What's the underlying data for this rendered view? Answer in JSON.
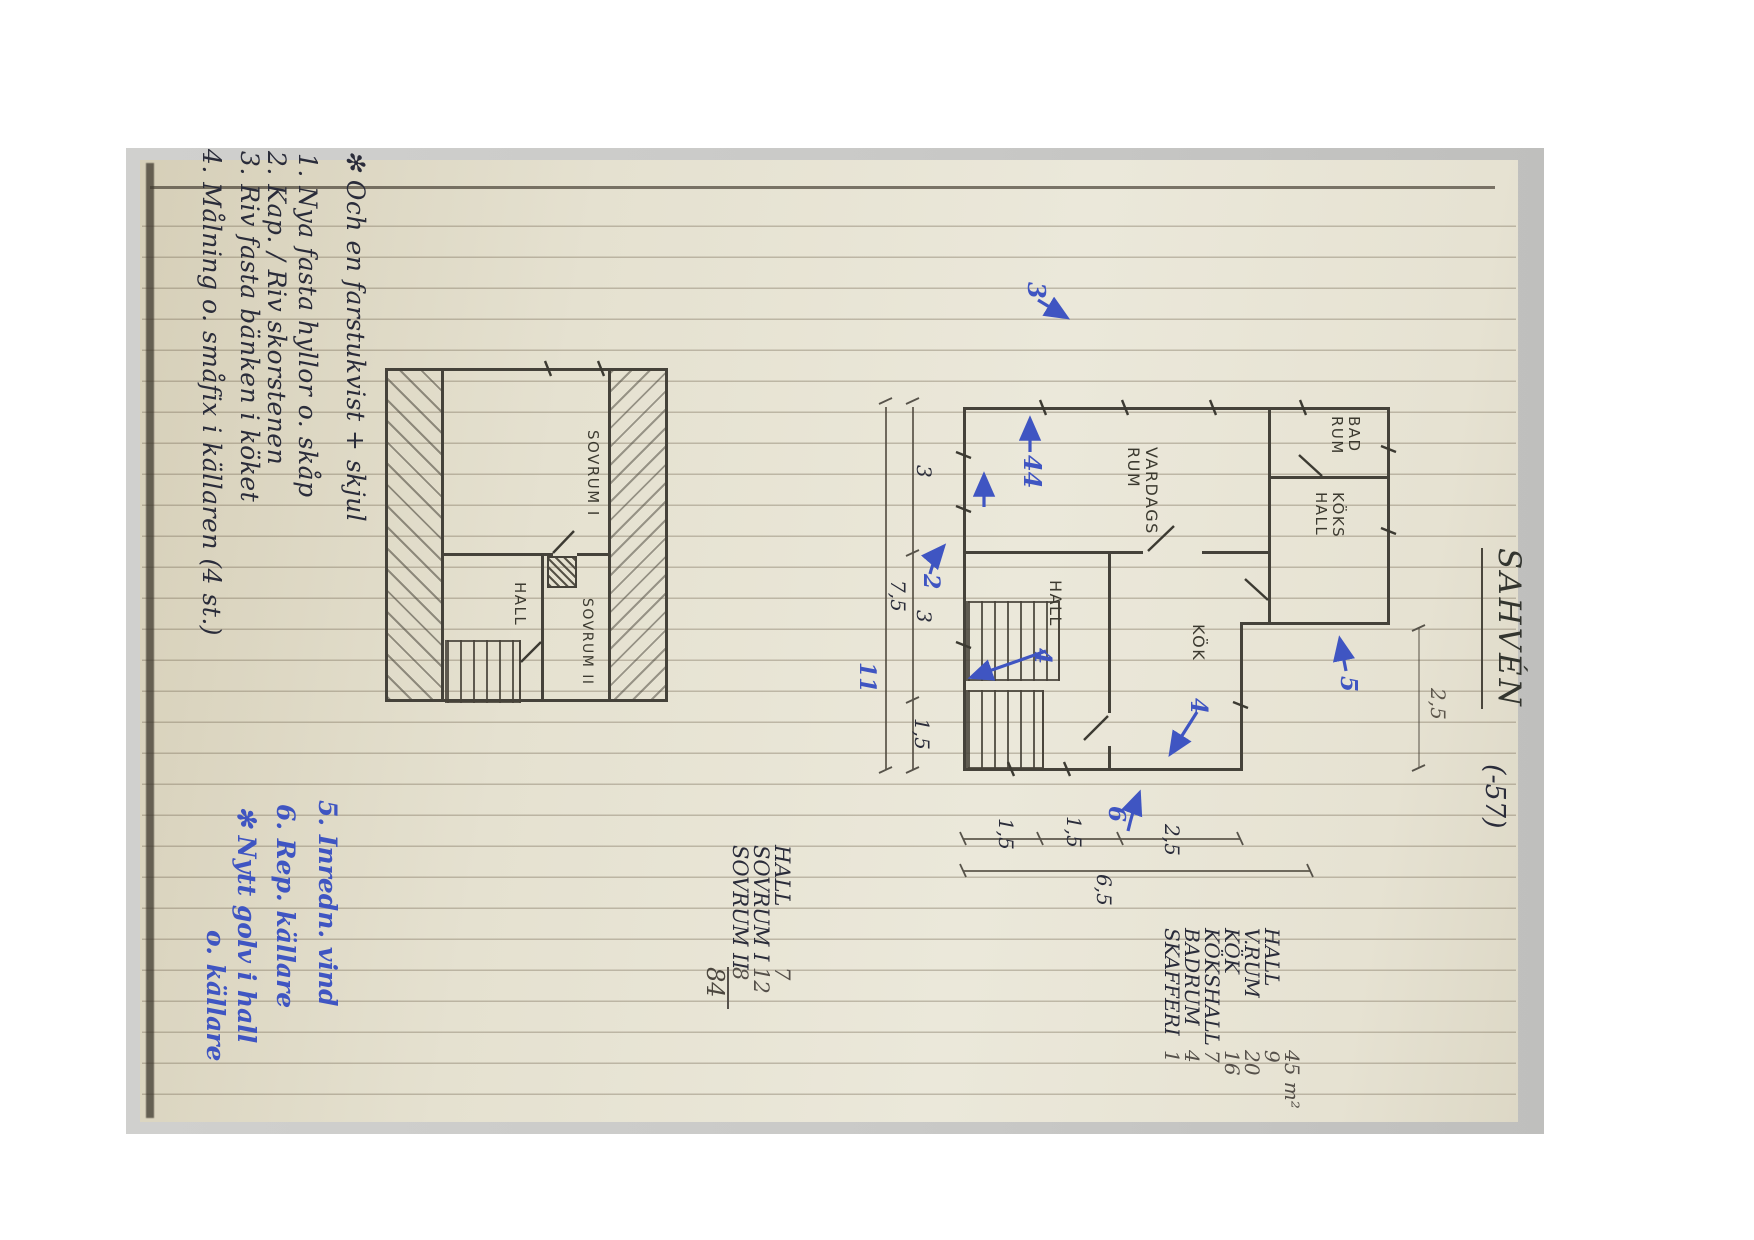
{
  "title": {
    "name": "SAHVÉN",
    "year": "(-57)"
  },
  "notes_black": [
    "✻  Och en farstukvist + skjul",
    "1.  Nya fasta hyllor o. skåp",
    "2.  Kap. / Riv skorstenen",
    "3.  Riv fasta bänken i köket",
    "4.  Målning o. småfix i källaren (4 st.)"
  ],
  "notes_blue": [
    "5.  Inredn. vind",
    "6.  Rep. källare",
    "✻  Nytt golv i hall",
    "o. källare"
  ],
  "ground_plan": {
    "rooms": {
      "vardagsrum_l1": "VARDAGS",
      "vardagsrum_l2": "RUM",
      "hall": "HALL",
      "kok": "KÖK",
      "badrum_l1": "BAD",
      "badrum_l2": "RUM",
      "kokshall_l1": "KÖKS",
      "kokshall_l2": "HALL"
    },
    "dims": {
      "left_overall": "7,5",
      "left_a": "3",
      "left_b": "3",
      "left_c": "1,5",
      "bottom_a": "1,5",
      "bottom_b": "1,5",
      "bottom_c": "2,5",
      "bottom_overall": "6,5",
      "right_pencil": "2,5"
    },
    "blue_edits": {
      "top": "3",
      "livingroom": "44",
      "wall": "2",
      "stairs": "11",
      "hall": "4",
      "kitchen": "4",
      "bottom": "6",
      "right": "5"
    }
  },
  "upper_plan": {
    "rooms": {
      "sovrum1": "SOVRUM I",
      "hall": "HALL",
      "sovrum2": "SOVRUM II"
    }
  },
  "schedule_upper": {
    "rows": [
      [
        "HALL",
        "7"
      ],
      [
        "SOVRUM I",
        "12"
      ],
      [
        "SOVRUM II",
        "8"
      ]
    ],
    "total": "84"
  },
  "schedule_ground": {
    "header": "45 m²",
    "rows": [
      [
        "HALL",
        "9"
      ],
      [
        "V.RUM",
        "20"
      ],
      [
        "KÖK",
        "16"
      ],
      [
        "KÖKSHALL",
        "7"
      ],
      [
        "BADRUM",
        "4"
      ],
      [
        "SKAFFERI",
        "1"
      ]
    ]
  }
}
